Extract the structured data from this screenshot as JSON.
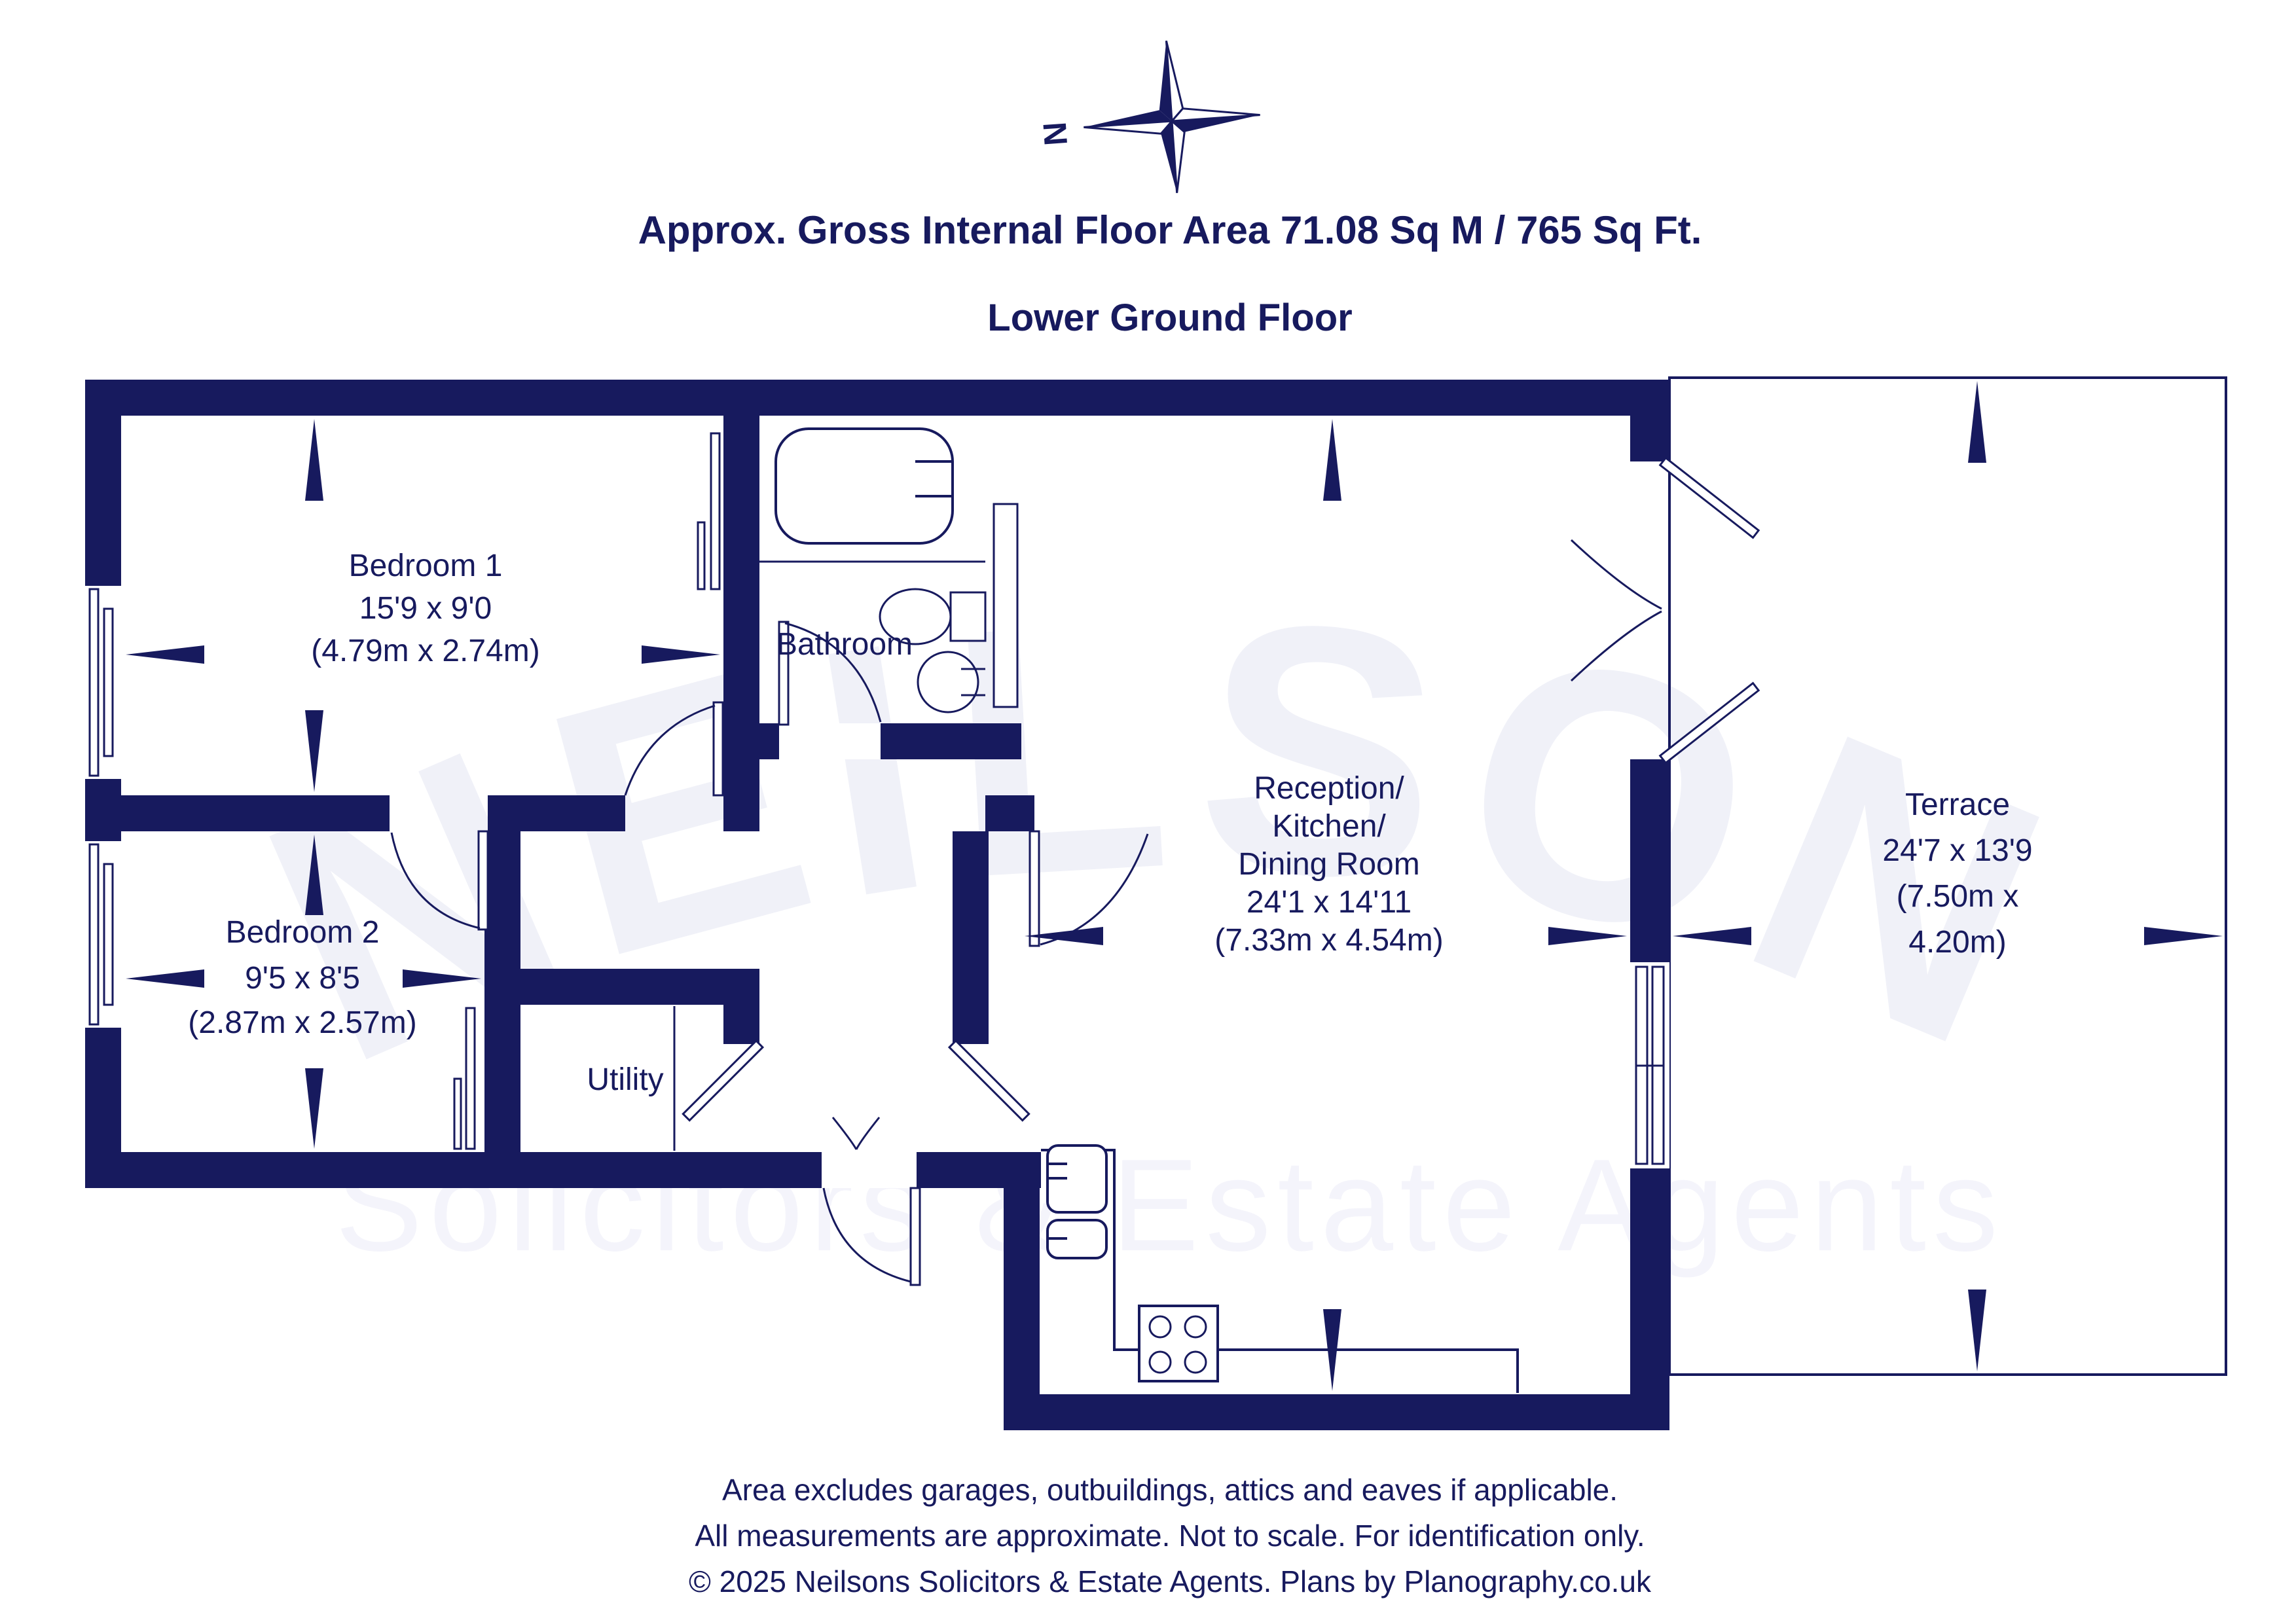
{
  "colors": {
    "navy": "#171a5e",
    "watermark_primary": "#f0f1f8",
    "watermark_secondary": "#f4f4fb",
    "floor": "#ffffff"
  },
  "header": {
    "area_line": "Approx. Gross Internal Floor Area 71.08 Sq M / 765 Sq Ft.",
    "floor_line": "Lower Ground Floor"
  },
  "compass": {
    "north_label": "N"
  },
  "watermark": {
    "primary": "NEILSONS",
    "secondary": "Solicitors & Estate Agents"
  },
  "rooms": {
    "bedroom1": {
      "lines": [
        "Bedroom 1",
        "15'9 x 9'0",
        "(4.79m x 2.74m)"
      ]
    },
    "bedroom2": {
      "lines": [
        "Bedroom 2",
        "9'5 x 8'5",
        "(2.87m x 2.57m)"
      ]
    },
    "bathroom": {
      "lines": [
        "Bathroom"
      ]
    },
    "utility": {
      "lines": [
        "Utility"
      ]
    },
    "reception": {
      "lines": [
        "Reception/",
        "Kitchen/",
        "Dining Room",
        "24'1 x 14'11",
        "(7.33m x 4.54m)"
      ]
    },
    "terrace": {
      "lines": [
        "Terrace",
        "24'7 x 13'9",
        "(7.50m x",
        "4.20m)"
      ]
    }
  },
  "footer": {
    "line1": "Area excludes garages, outbuildings, attics and eaves if applicable.",
    "line2": "All measurements are approximate. Not to scale. For identification only.",
    "line3": "© 2025 Neilsons Solicitors & Estate Agents. Plans by Planography.co.uk"
  }
}
